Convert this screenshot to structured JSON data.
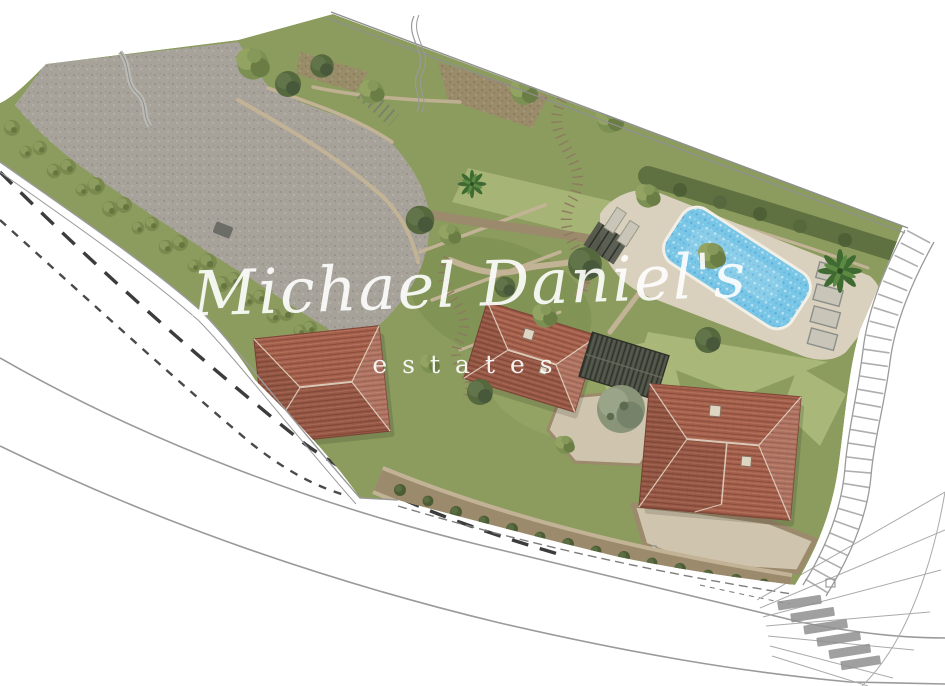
{
  "watermark": {
    "script": "Michael Daniel's",
    "subtitle": "estates"
  },
  "colors": {
    "bg": "#ffffff",
    "gravel": "#a7a39b",
    "gravel-dot": "#8d8981",
    "gravel-light": "#bdb9b1",
    "grass": "#8c9c5f",
    "grass-light": "#a9b779",
    "grass-dark": "#75894c",
    "hedge": "#5f7140",
    "tree": "#7d9054",
    "tree-dark": "#55683e",
    "olive": "#8a9478",
    "soil": "#9b8a6b",
    "soil-dot": "#7c6c50",
    "path-tan": "#c3b396",
    "courtyard": "#cfc5ae",
    "deck": "#d9d0bd",
    "wall-line": "#8a8a7a",
    "roof-red": "#a5604b",
    "roof-red-line": "#7e4537",
    "roof-red-light": "#c78a74",
    "roof-ridge": "#e6dccb",
    "roof-dark": "#4e5247",
    "slat-line": "#2e3129",
    "pool": "#79c6e6",
    "pool-deep": "#4fa0cf",
    "lounger": "#c9c5b8",
    "line-grey": "#9a9a9a",
    "dash-dark": "#3c3c3c",
    "crosswalk": "#8f8f8f",
    "watermark": "#ffffff"
  }
}
